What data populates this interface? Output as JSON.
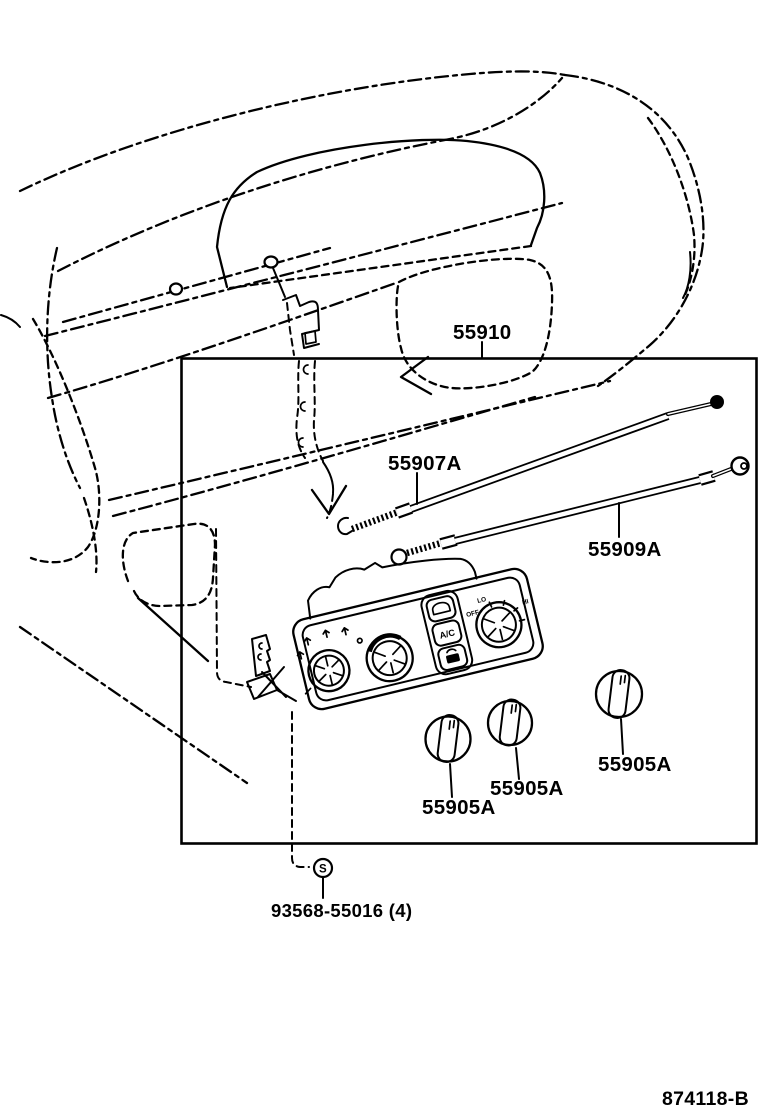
{
  "figure": {
    "code": "874118-B"
  },
  "parts": {
    "control_assy_dash": {
      "number": "55910"
    },
    "cable_air_inlet_damper": {
      "number": "55907A"
    },
    "cable_air_mix_damper": {
      "number": "55909A"
    },
    "knobs": [
      {
        "number": "55905A"
      },
      {
        "number": "55905A"
      },
      {
        "number": "55905A"
      }
    ],
    "screw": {
      "number": "93568-55016 (4)",
      "symbol": "S"
    }
  },
  "control_panel_markings": {
    "ac_button": "A/C",
    "fan_off": "OFF",
    "fan_lo": "LO",
    "fan_hi": "HI"
  },
  "colors": {
    "line": "#000000",
    "background": "#ffffff"
  }
}
